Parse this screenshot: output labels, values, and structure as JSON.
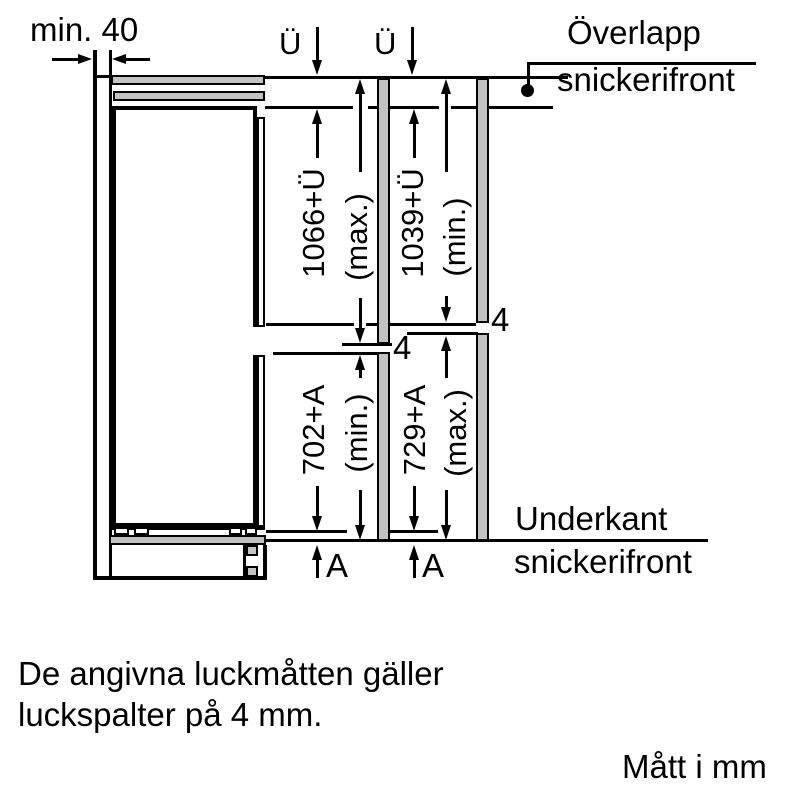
{
  "diagram": {
    "side_clearance_label": "min. 40",
    "overlap_symbol_1": "Ü",
    "overlap_symbol_2": "Ü",
    "overlap_caption_line1": "Överlapp",
    "overlap_caption_line2": "snickerifront",
    "bottom_caption_line1": "Underkant",
    "bottom_caption_line2": "snickerifront",
    "dim_upper_variant1_value": "1066+Ü",
    "dim_upper_variant1_qualifier": "(max.)",
    "dim_upper_variant2_value": "1039+Ü",
    "dim_upper_variant2_qualifier": "(min.)",
    "dim_lower_variant1_value": "702+A",
    "dim_lower_variant1_qualifier": "(min.)",
    "dim_lower_variant2_value": "729+A",
    "dim_lower_variant2_qualifier": "(max.)",
    "gap_label_variant1": "4",
    "gap_label_variant2": "4",
    "overhang_label_1": "A",
    "overhang_label_2": "A"
  },
  "footer": {
    "note_line1": "De angivna luckmåtten gäller",
    "note_line2": "luckspalter på 4 mm.",
    "units_label": "Mått i mm"
  },
  "colors": {
    "line": "#000000",
    "panel_fill": "#c2c2c2",
    "background": "#ffffff"
  }
}
